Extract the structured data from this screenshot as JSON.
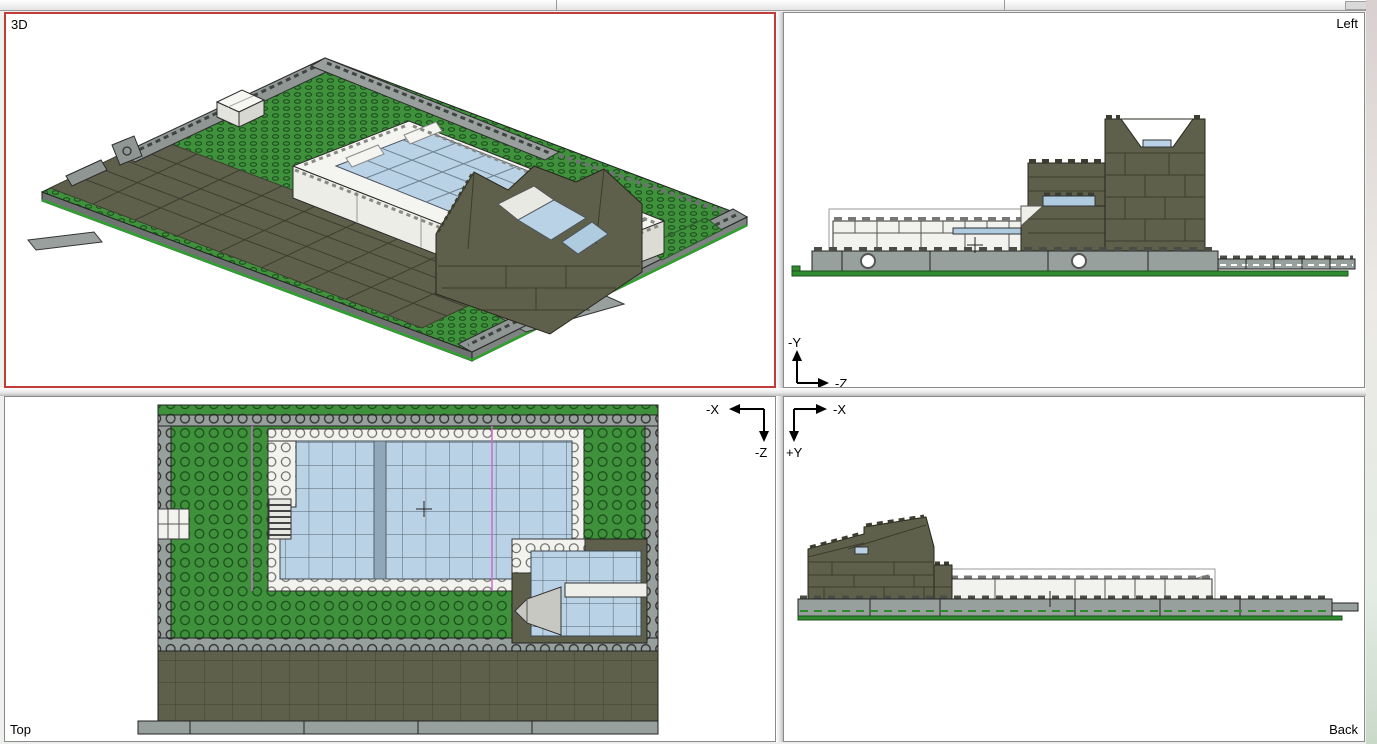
{
  "viewports": {
    "perspective": {
      "label": "3D",
      "active": true
    },
    "left": {
      "label": "Left",
      "axis_up": "-Y",
      "axis_right": "-Z"
    },
    "top": {
      "label": "Top",
      "axis_left": "-X",
      "axis_down": "-Z"
    },
    "back": {
      "label": "Back",
      "axis_right": "-X",
      "axis_down": "+Y"
    }
  },
  "colors": {
    "active_viewport_border": "#C23B3B",
    "grass_green": "#3F923B",
    "plate_gray": "#98A09E",
    "olive_dark_gray": "#5F604B",
    "brick_white": "#F2F2EE",
    "glass_blue": "#B9D2E6",
    "base_edge_green": "#2E8B2E",
    "selection_magenta": "#C86EC8"
  }
}
